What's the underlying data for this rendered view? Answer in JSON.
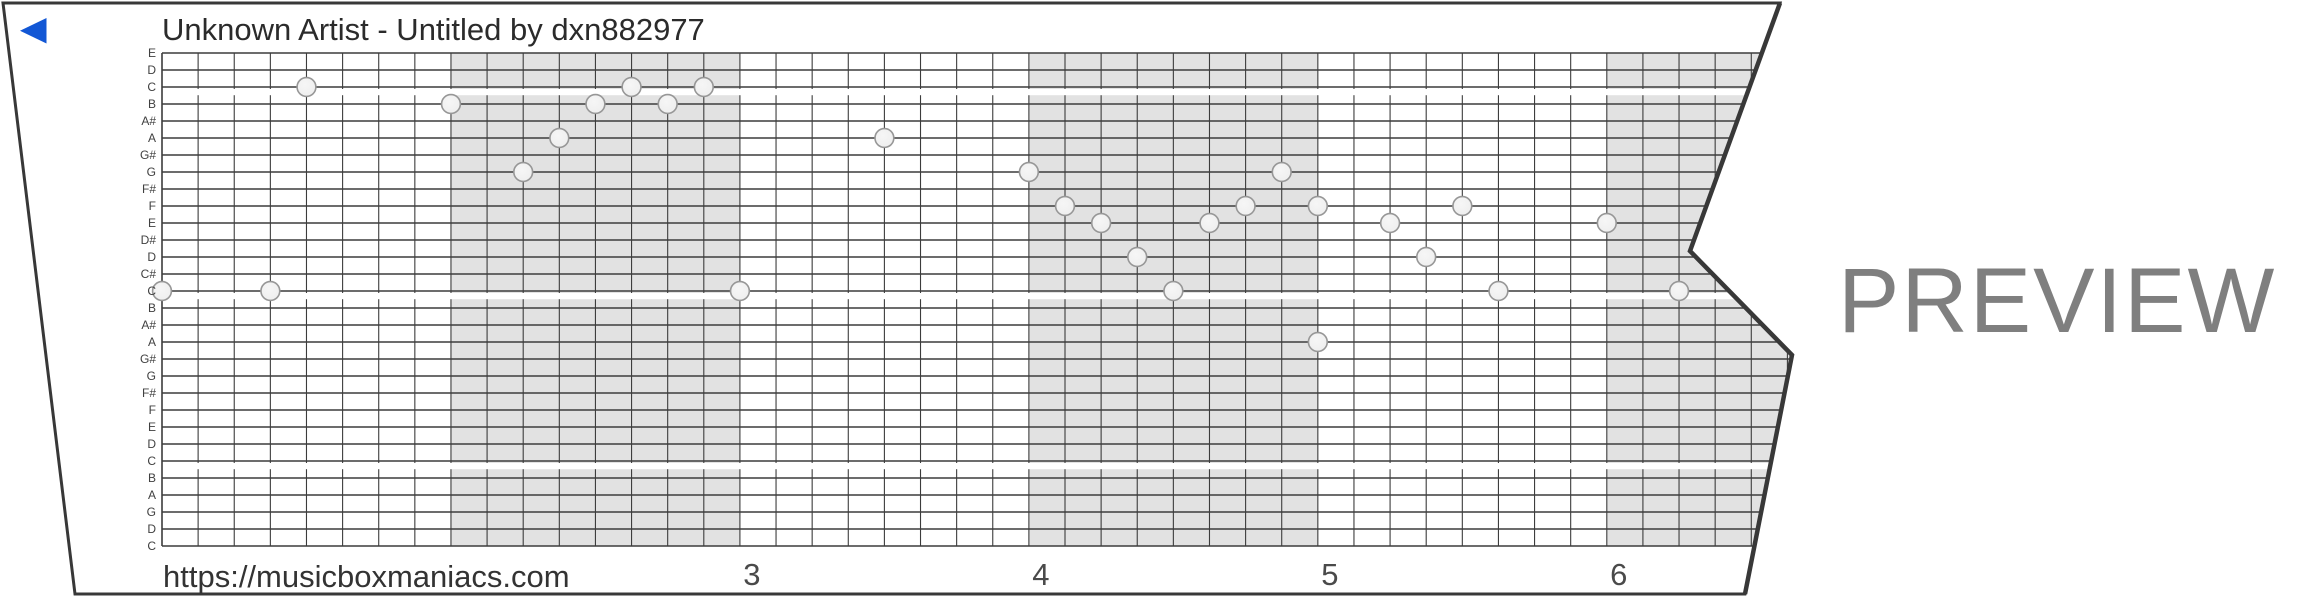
{
  "header": {
    "title": "Unknown Artist - Untitled by dxn882977"
  },
  "player": {
    "back_icon": "left-triangle",
    "back_icon_color": "#1257d5"
  },
  "watermark": {
    "label": "PREVIEW",
    "color": "#7f7f7f"
  },
  "footer": {
    "url": "https://musicboxmaniacs.com",
    "measure_numbers": [
      "3",
      "4",
      "5",
      "6"
    ]
  },
  "strip": {
    "row_labels": [
      "E",
      "D",
      "C",
      "B",
      "A#",
      "A",
      "G#",
      "G",
      "F#",
      "F",
      "E",
      "D#",
      "D",
      "C#",
      "C",
      "B",
      "A#",
      "A",
      "G#",
      "G",
      "F#",
      "F",
      "E",
      "D",
      "C",
      "B",
      "A",
      "G",
      "D",
      "C"
    ],
    "octave_break_rows": [
      2,
      14,
      24
    ],
    "shaded_measures": [
      2,
      4,
      6
    ],
    "colors": {
      "paper": "#ffffff",
      "border": "#383838",
      "grid_line": "#3c3c3c",
      "shade": "#e2e2e2",
      "note_fill": "#f1f1f1",
      "note_stroke": "#979797",
      "label_text": "#404040",
      "title_text": "#2b2b2b",
      "number_text": "#4a4a4a",
      "url_text": "#333333"
    }
  },
  "chart_data": {
    "type": "piano-roll",
    "unit": "column = 16th-note half-grid step, row = 0-based line from top",
    "notes": [
      {
        "col": 0,
        "row": 14,
        "pitch": "C"
      },
      {
        "col": 6,
        "row": 14,
        "pitch": "C"
      },
      {
        "col": 8,
        "row": 2,
        "pitch": "C"
      },
      {
        "col": 16,
        "row": 3,
        "pitch": "B"
      },
      {
        "col": 20,
        "row": 7,
        "pitch": "G"
      },
      {
        "col": 22,
        "row": 5,
        "pitch": "A"
      },
      {
        "col": 24,
        "row": 3,
        "pitch": "B"
      },
      {
        "col": 26,
        "row": 2,
        "pitch": "C"
      },
      {
        "col": 28,
        "row": 3,
        "pitch": "B"
      },
      {
        "col": 30,
        "row": 2,
        "pitch": "C"
      },
      {
        "col": 32,
        "row": 14,
        "pitch": "C"
      },
      {
        "col": 40,
        "row": 5,
        "pitch": "A"
      },
      {
        "col": 48,
        "row": 7,
        "pitch": "G"
      },
      {
        "col": 50,
        "row": 9,
        "pitch": "F"
      },
      {
        "col": 52,
        "row": 10,
        "pitch": "E"
      },
      {
        "col": 54,
        "row": 12,
        "pitch": "D"
      },
      {
        "col": 56,
        "row": 14,
        "pitch": "C"
      },
      {
        "col": 58,
        "row": 10,
        "pitch": "E"
      },
      {
        "col": 60,
        "row": 9,
        "pitch": "F"
      },
      {
        "col": 62,
        "row": 7,
        "pitch": "G"
      },
      {
        "col": 64,
        "row": 9,
        "pitch": "F"
      },
      {
        "col": 64,
        "row": 17,
        "pitch": "A"
      },
      {
        "col": 68,
        "row": 10,
        "pitch": "E"
      },
      {
        "col": 70,
        "row": 12,
        "pitch": "D"
      },
      {
        "col": 72,
        "row": 9,
        "pitch": "F"
      },
      {
        "col": 74,
        "row": 14,
        "pitch": "C"
      },
      {
        "col": 80,
        "row": 10,
        "pitch": "E"
      },
      {
        "col": 84,
        "row": 14,
        "pitch": "C"
      }
    ]
  }
}
